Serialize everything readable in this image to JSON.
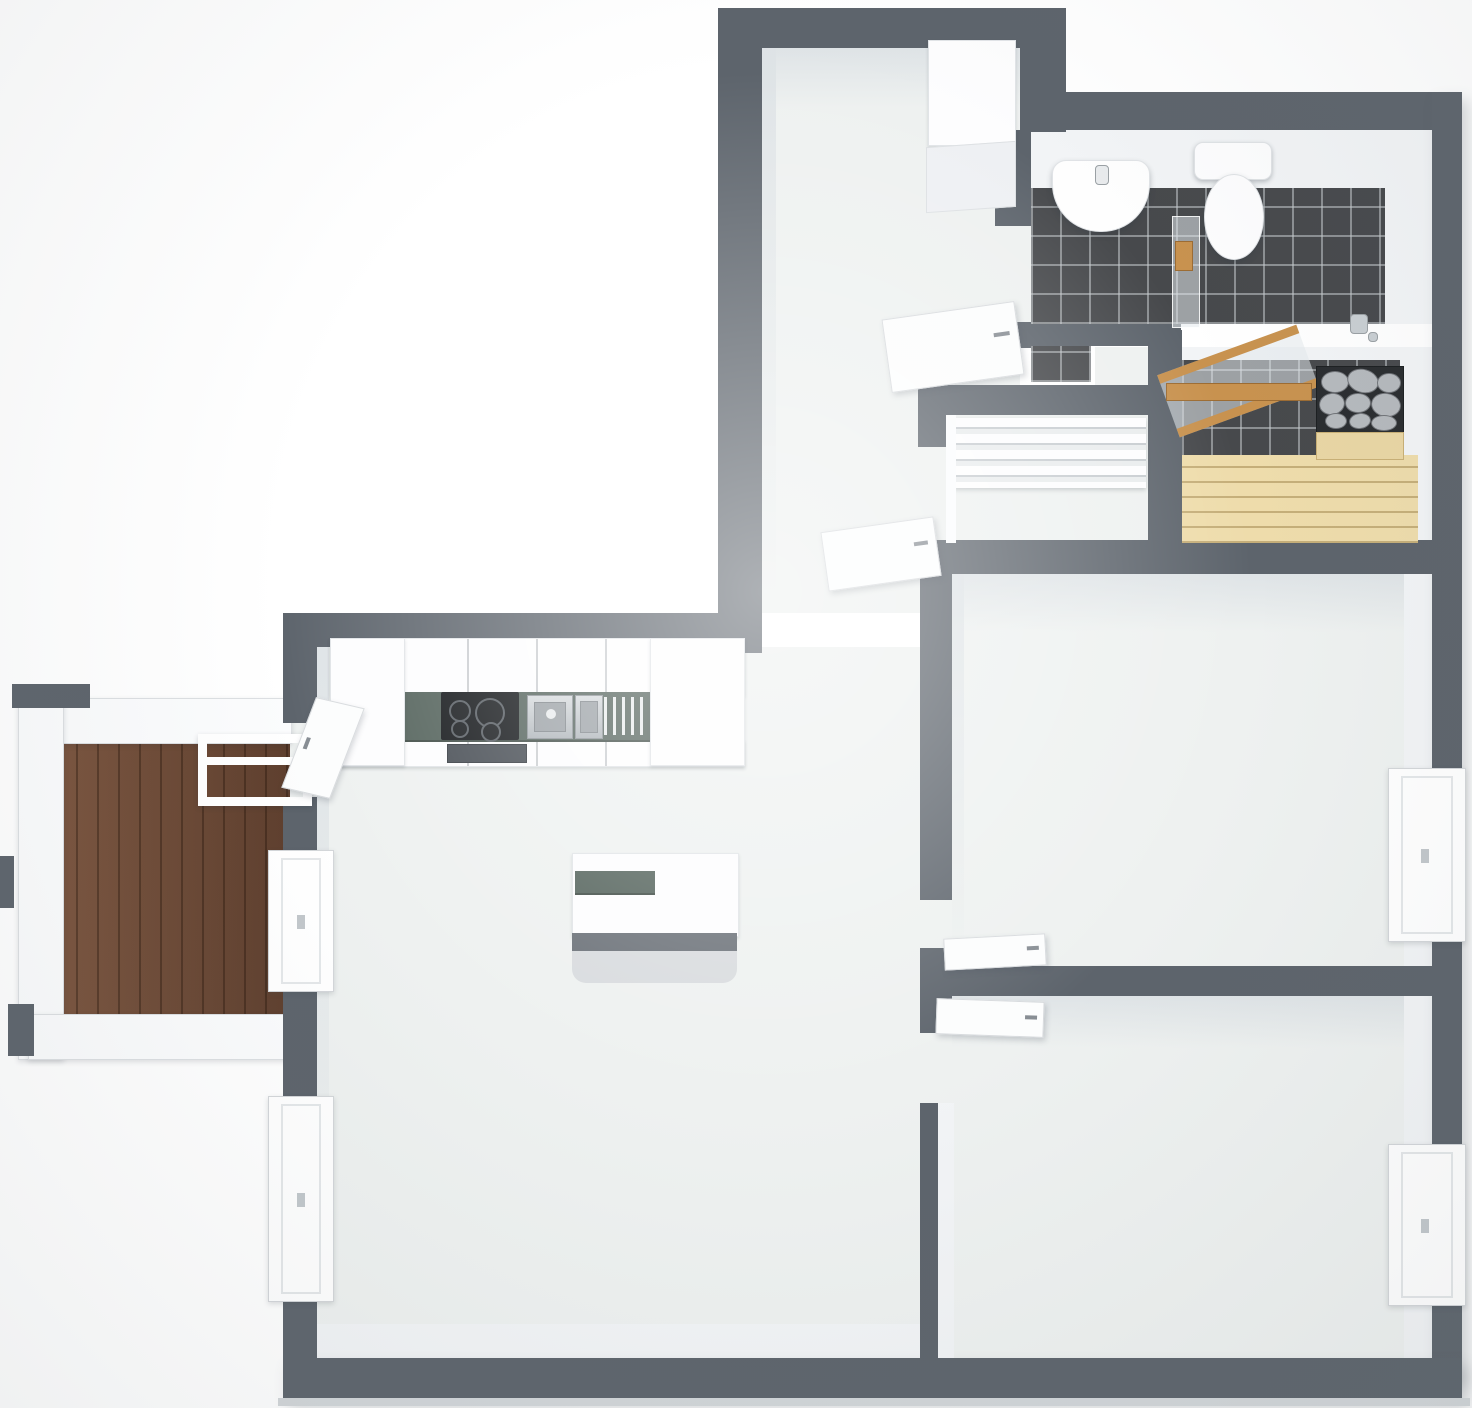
{
  "meta": {
    "title": "3D apartment floor plan — top-down dollhouse render, no text labels",
    "canvas_width": 1472,
    "canvas_height": 1408
  },
  "palette": {
    "wall": "#5d646c",
    "wall2": "#d2d6d9",
    "floor": "#eef1f0",
    "face": "#f2f4f6",
    "tile": "#47494c",
    "deck": "#6d4a37",
    "rail": "#fbfcfd",
    "bench": "#eedcab",
    "counter": "#52615a",
    "cooktop": "#101316",
    "steel": "#c7ccd0",
    "stone": "#b5b9bd",
    "stonebox": "#2a2d30",
    "wood": "#c8924f",
    "glass": "rgba(228,233,236,0.55)",
    "door": "#fcfdfd"
  },
  "rooms": [
    {
      "id": "hallway",
      "label": "Entry hallway",
      "fixtures": [
        "tall white wardrobe",
        "cabinet"
      ]
    },
    {
      "id": "living-kitchen",
      "label": "Living room with open kitchen",
      "fixtures": [
        "kitchen counter",
        "kitchen island"
      ]
    },
    {
      "id": "bathroom",
      "label": "Bathroom",
      "floor": "dark grey tile",
      "fixtures": [
        "washbasin",
        "toilet",
        "glass shower screen",
        "floor drain"
      ]
    },
    {
      "id": "sauna",
      "label": "Sauna",
      "floor": "dark grey tile",
      "fixtures": [
        "wooden benches",
        "stone-filled sauna heater",
        "open wood-framed glass door"
      ]
    },
    {
      "id": "walk-in-closet",
      "label": "Walk-in closet",
      "fixtures": [
        "white shelving unit"
      ]
    },
    {
      "id": "bedroom-top",
      "label": "Bedroom (upper right)",
      "fixtures": [
        "window"
      ]
    },
    {
      "id": "bedroom-bottom",
      "label": "Bedroom (lower right)",
      "fixtures": [
        "window"
      ]
    },
    {
      "id": "balcony",
      "label": "Balcony",
      "floor": "brown wood deck",
      "fixtures": [
        "white railing",
        "white folding rack"
      ]
    }
  ],
  "kitchen": {
    "counter_color": "dark grey-green",
    "appliances": [
      "induction cooktop with 4 burners",
      "oven",
      "stainless double sink",
      "dish drying rack",
      "tall cabinet"
    ],
    "island": true
  },
  "doors": [
    {
      "to": "bathroom",
      "state": "open into hallway"
    },
    {
      "to": "walk-in-closet",
      "state": "open into hallway"
    },
    {
      "to": "bedroom-top",
      "state": "open into bedroom"
    },
    {
      "to": "bedroom-bottom",
      "state": "open into bedroom"
    },
    {
      "to": "balcony",
      "state": "open into living room"
    },
    {
      "to": "sauna",
      "state": "open, wood-framed glass leaf"
    }
  ],
  "windows": [
    {
      "wall": "left",
      "room": "living-kitchen",
      "count": 2
    },
    {
      "wall": "right",
      "room": "bedroom-top",
      "count": 1
    },
    {
      "wall": "right",
      "room": "bedroom-bottom",
      "count": 1
    }
  ]
}
